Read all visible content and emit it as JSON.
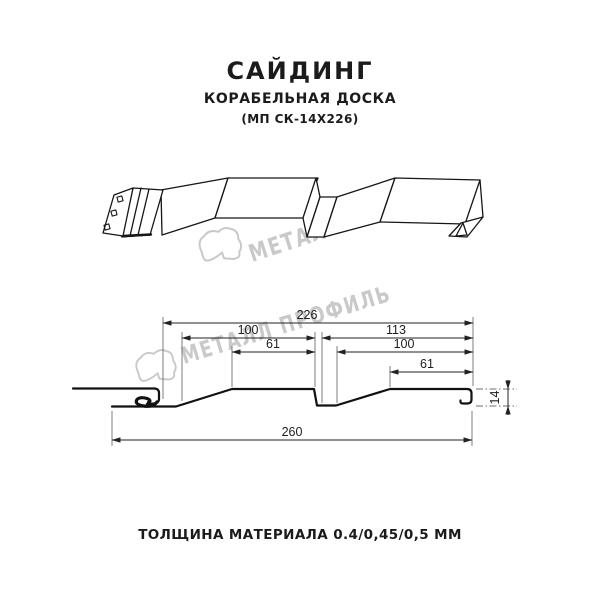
{
  "header": {
    "title": "САЙДИНГ",
    "subtitle": "КОРАБЕЛЬНАЯ ДОСКА",
    "product_code": "(МП СК-14Х226)"
  },
  "footer": {
    "material_thickness": "ТОЛЩИНА МАТЕРИАЛА 0.4/0,45/0,5 ММ"
  },
  "watermark": {
    "brand": "МЕТАЛЛ ПРОФИЛЬ",
    "color": "#c9c9c9"
  },
  "drawing": {
    "type": "technical-profile-drawing",
    "views": [
      "perspective-3d",
      "cross-section"
    ],
    "dimensions_mm": {
      "cover_width": "226",
      "left_board_width": "100",
      "left_board_top_flat": "61",
      "right_span": "113",
      "right_board_width": "100",
      "right_board_top_flat": "61",
      "overall_width": "260",
      "profile_height": "14"
    },
    "palette": {
      "ink": "#1b1b1b",
      "line": "#1d1d1d",
      "extension_line": "#6e6e6e",
      "watermark": "#c9c9c9",
      "background": "#ffffff"
    }
  }
}
